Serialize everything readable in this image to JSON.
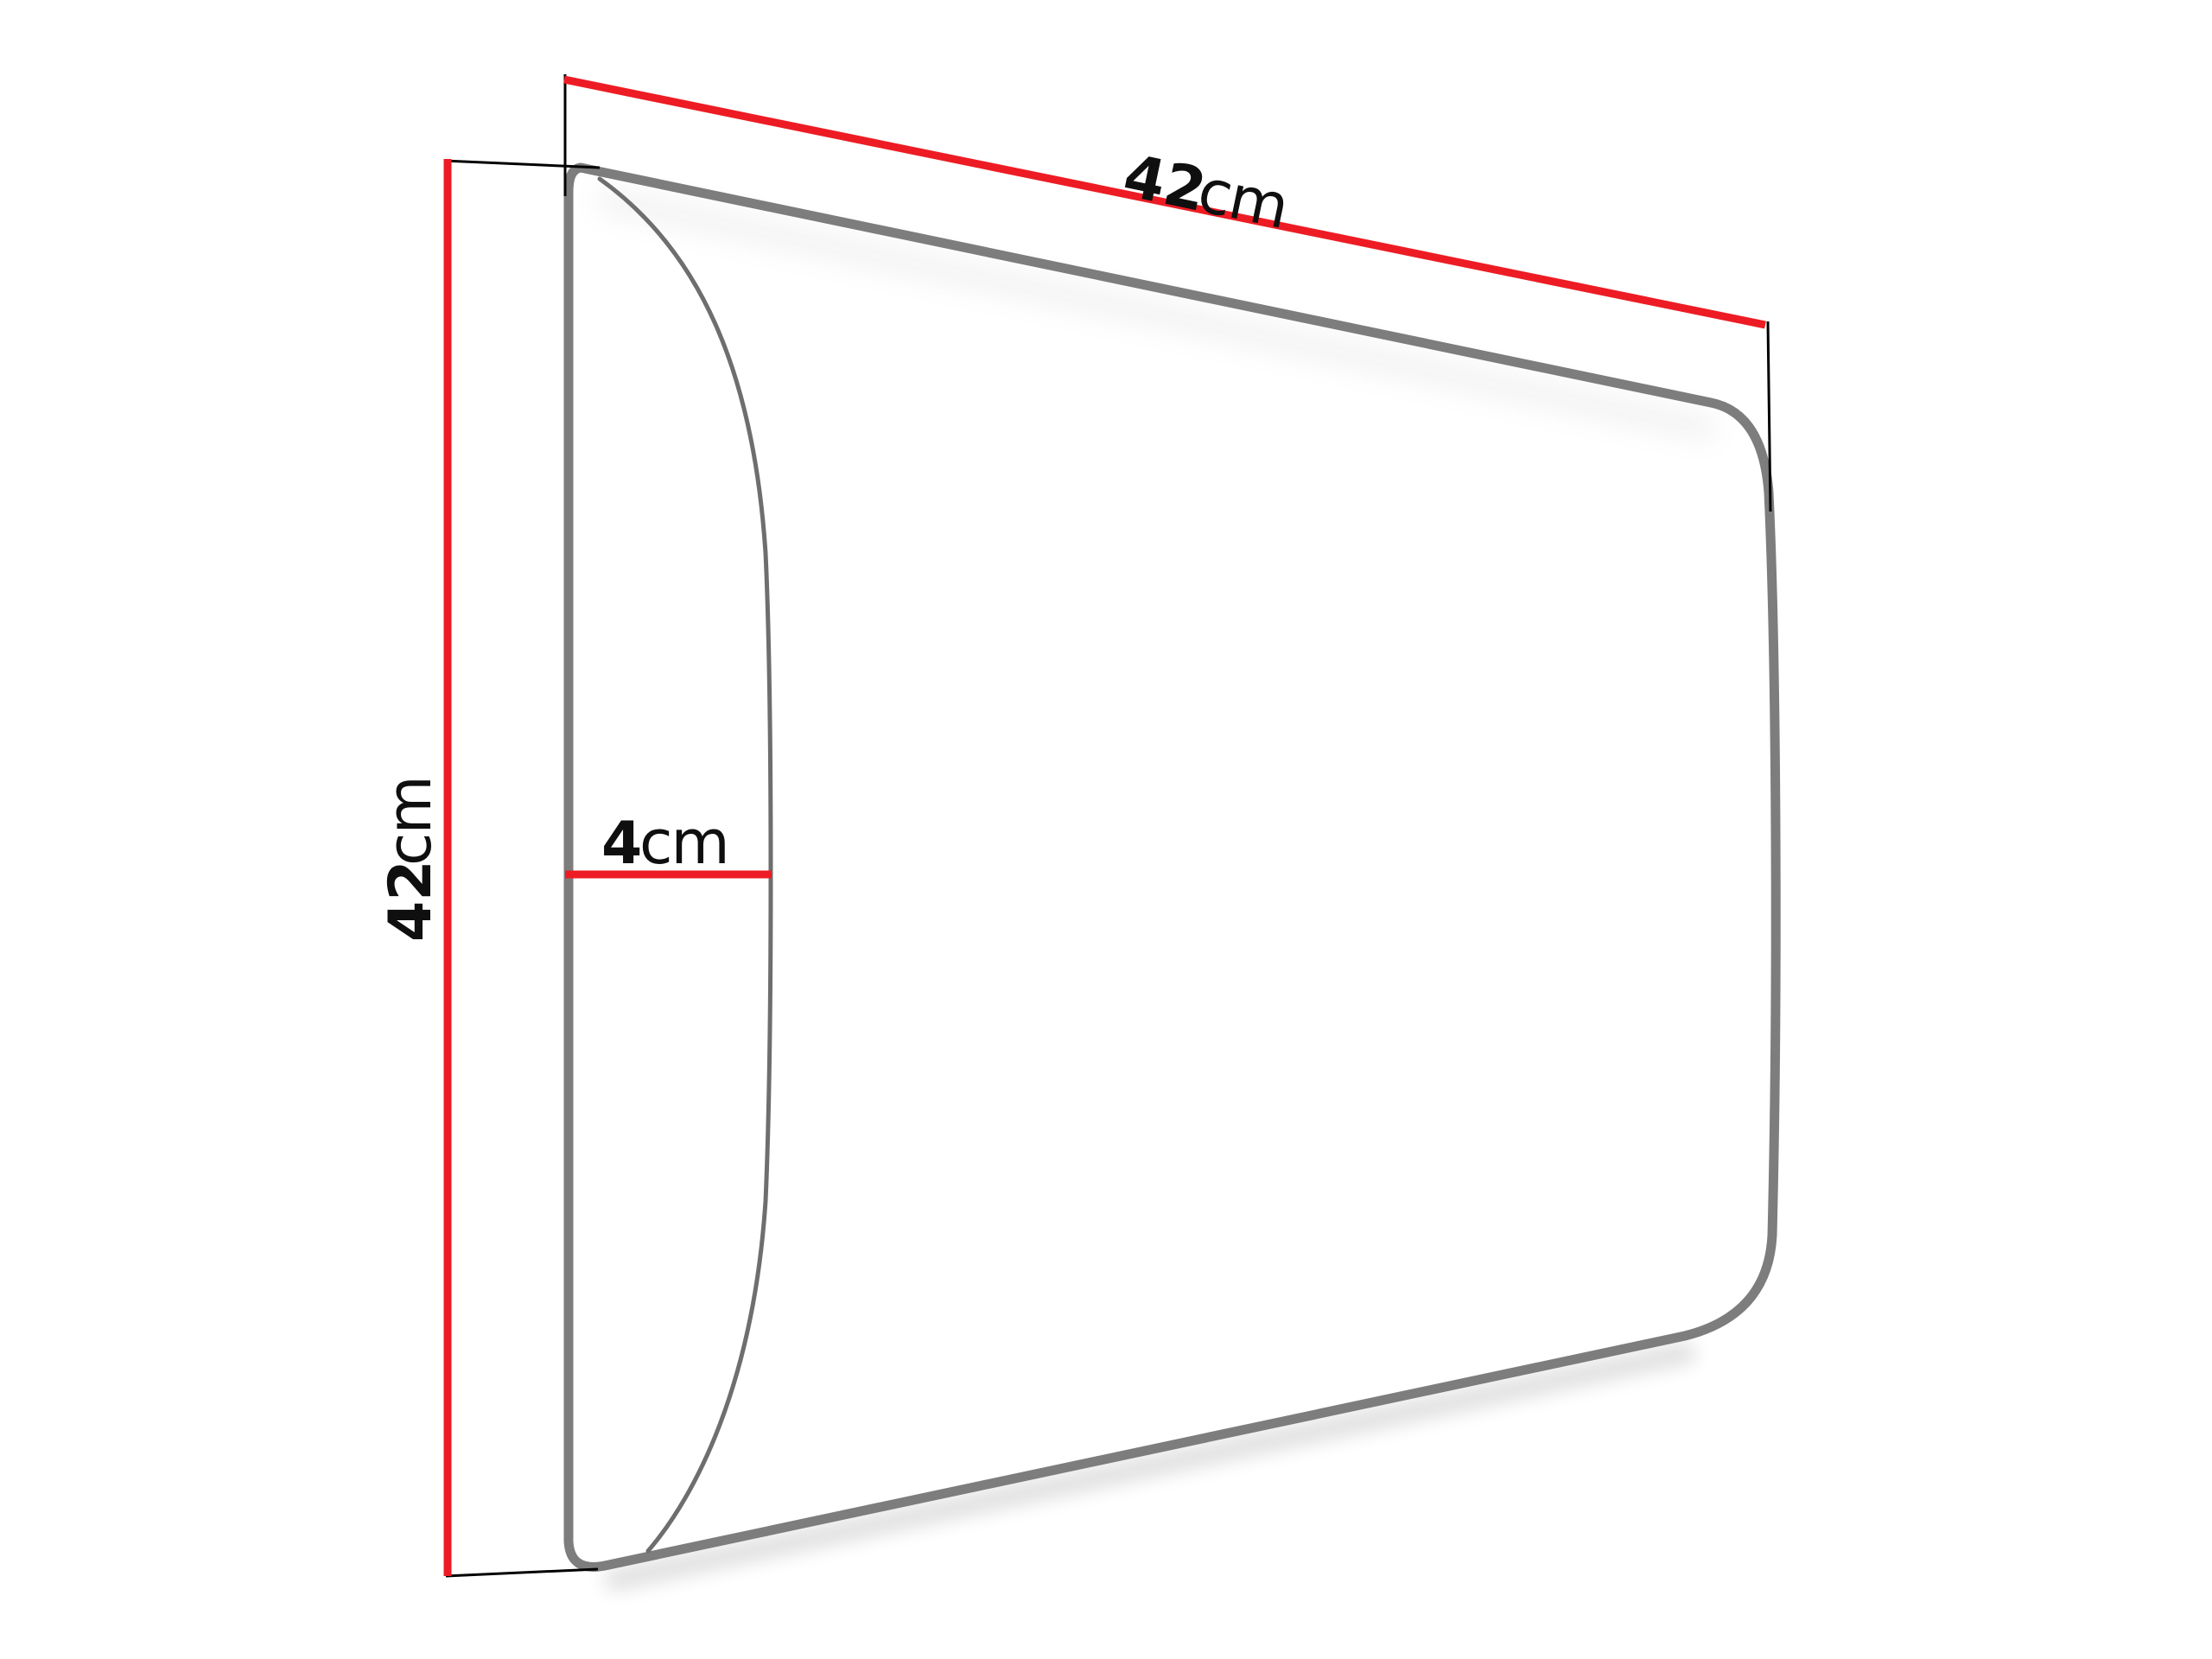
{
  "diagram": {
    "dimensions": {
      "width": {
        "value": "42",
        "unit": "cm"
      },
      "height": {
        "value": "42",
        "unit": "cm"
      },
      "depth": {
        "value": "4",
        "unit": "cm"
      }
    },
    "colors": {
      "dimension_line": "#ED1C24",
      "panel_outline": "#7D7D7D",
      "panel_side_curve": "#6E6E6E",
      "extension_line": "#000000",
      "label_text": "#0F0F0F",
      "background": "#FFFFFF"
    }
  }
}
